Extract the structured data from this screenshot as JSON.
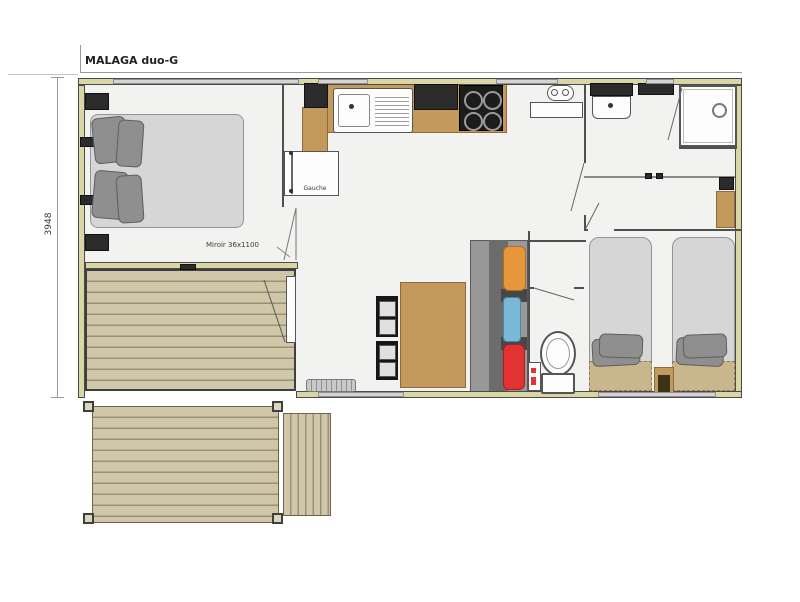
{
  "floorplan": {
    "title": "MALAGA duo-G",
    "dimension_height": "3948",
    "labels": {
      "wardrobe_door": "Gauche",
      "mirror": "Miroir 36x1100"
    },
    "colors": {
      "wall": "#d9d6a4",
      "floor": "#f2f2f0",
      "deck": "#cfc7a7",
      "deck_line": "#97907a",
      "counter": "#c49a5c",
      "appliance_dark": "#2b2b2b",
      "bed": "#d6d6d6",
      "pillow": "#8f8f8f",
      "sofa": "#989898",
      "cushion_orange": "#e6973c",
      "cushion_blue": "#7ab8d4",
      "cushion_red": "#e23232",
      "blanket": "#c9b68c",
      "line": "#4f4f4f"
    }
  }
}
